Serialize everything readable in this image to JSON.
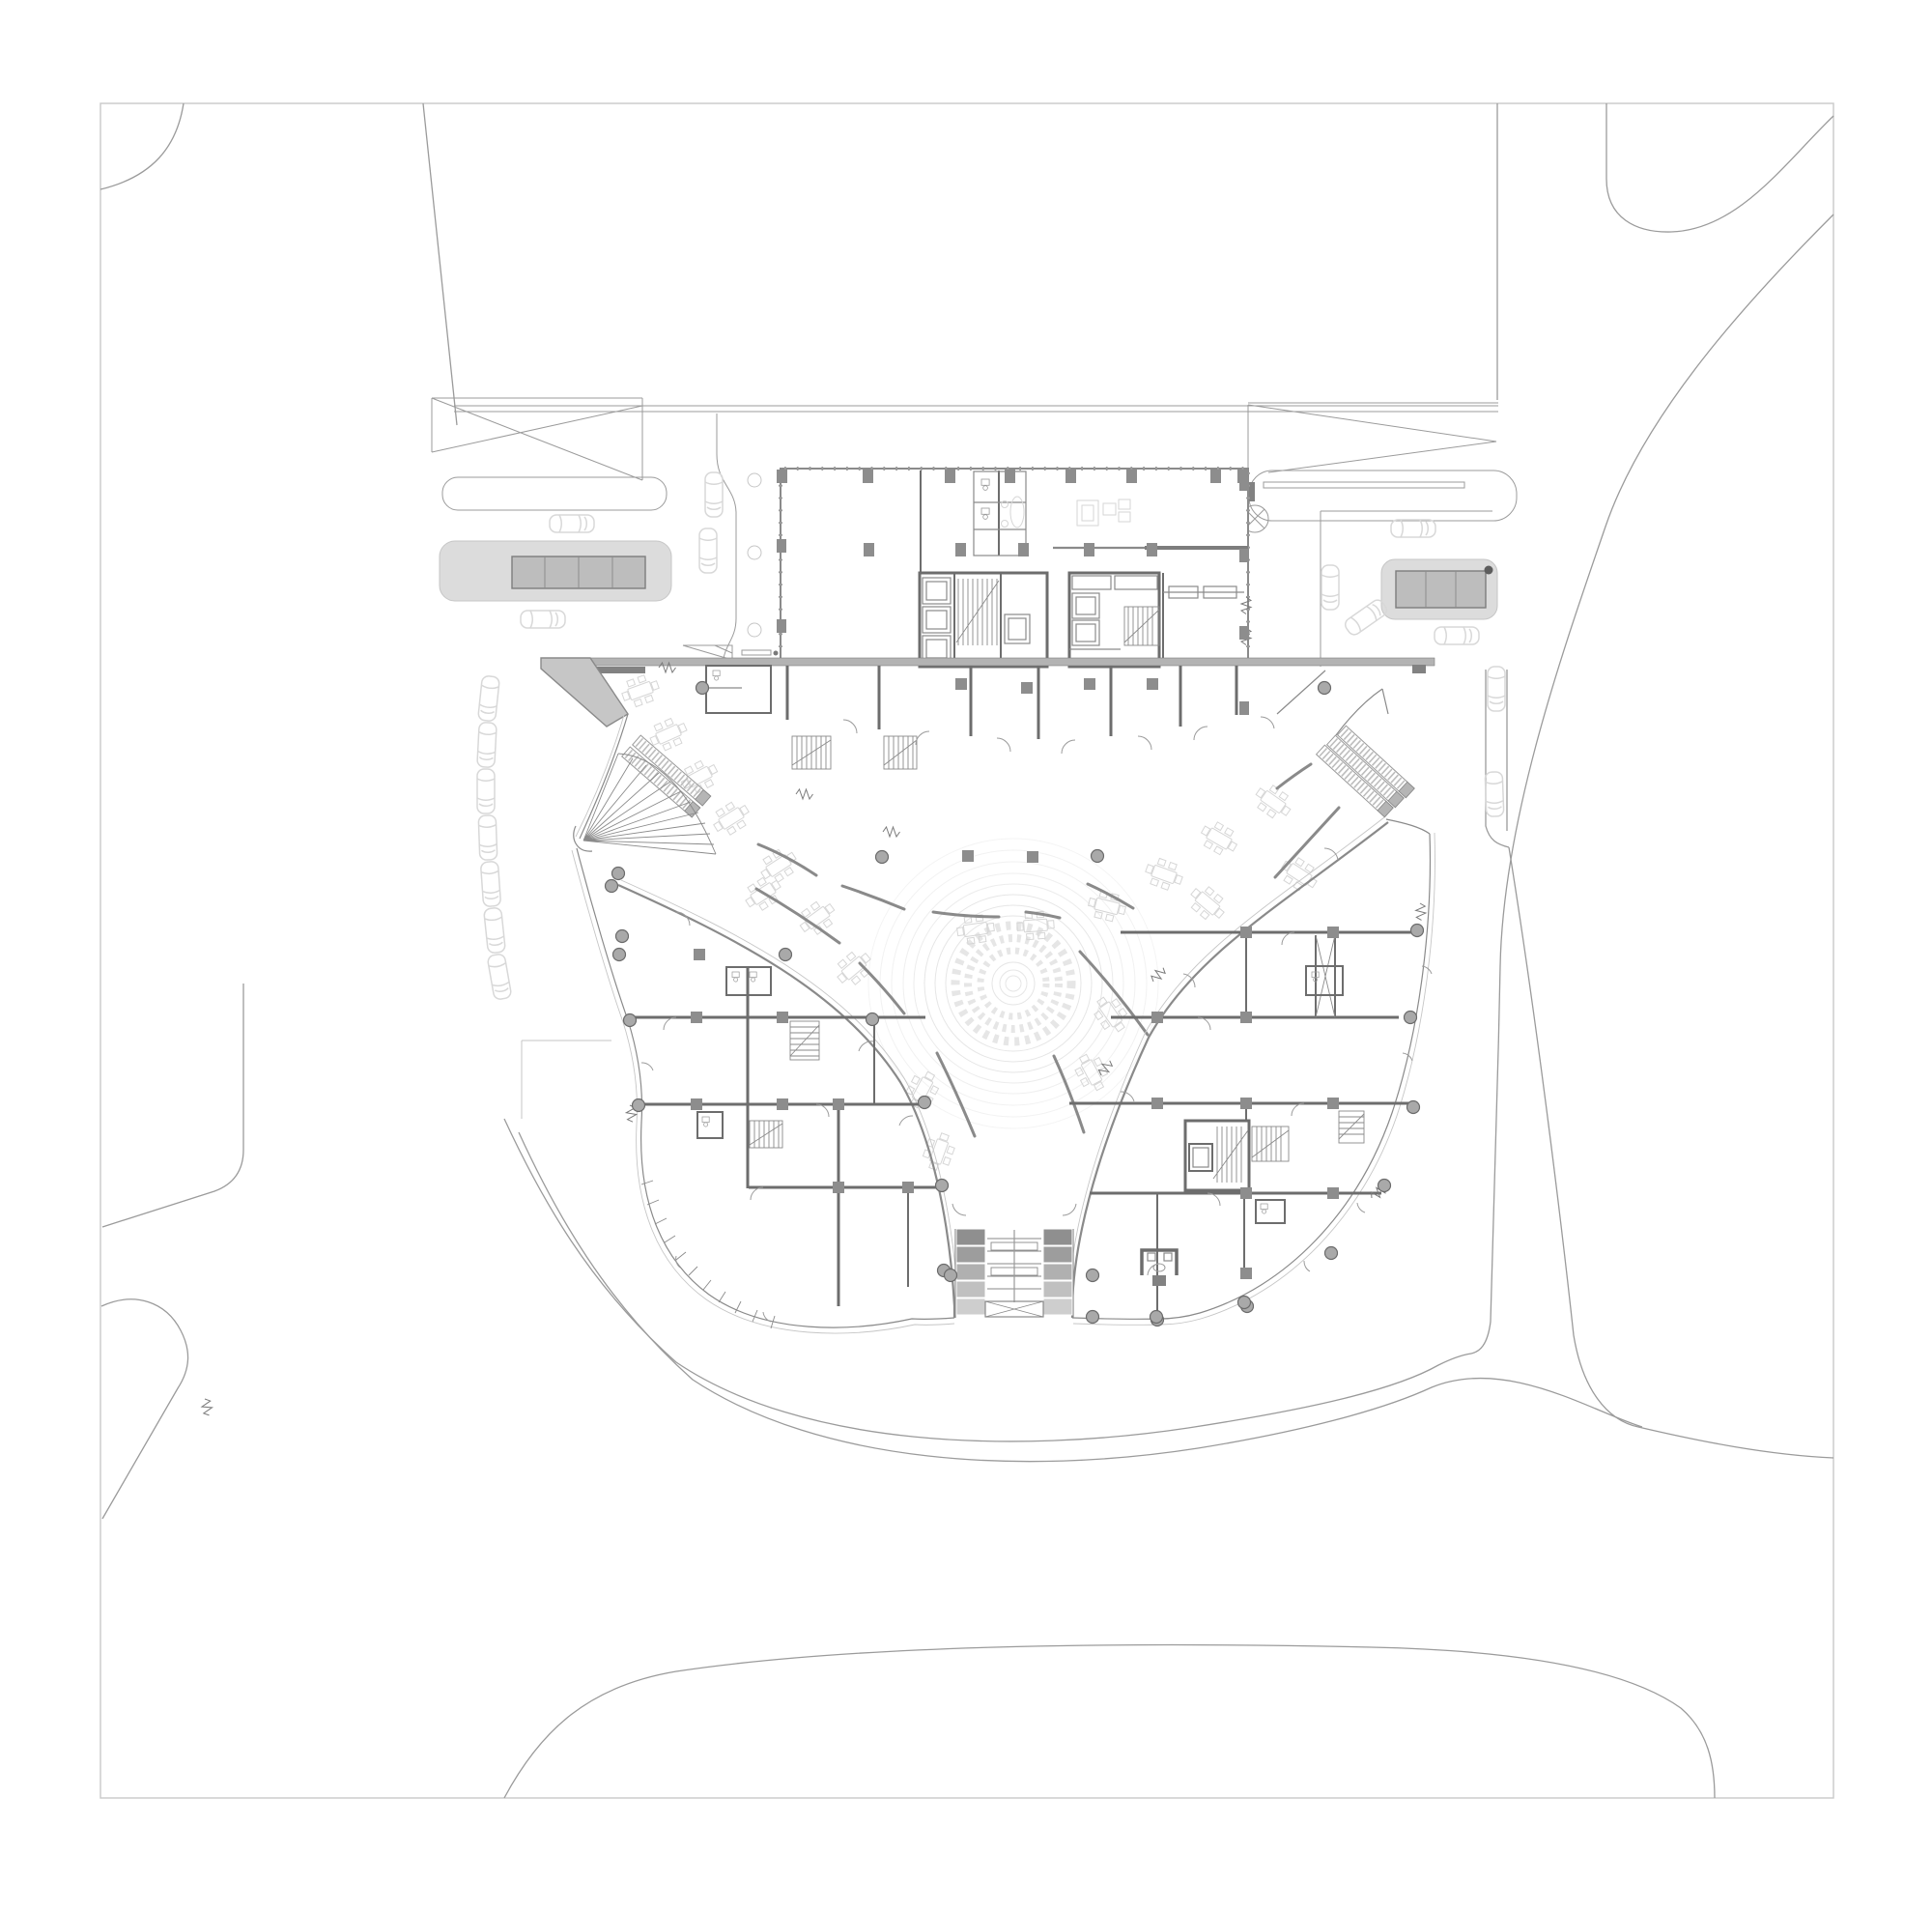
{
  "sheet": {
    "visible_text": [],
    "kind": "architectural ground-floor site plan, line drawing, no text labels",
    "symbols": [
      "car",
      "parking-pad",
      "drop-off-curb",
      "ramp-hatch",
      "tower-floor-plate",
      "elevator-core",
      "stair",
      "escalator-bank",
      "fan-stair",
      "canopy",
      "entrance-wedge",
      "shop-stub",
      "seating-cluster",
      "bench-wall",
      "round-column",
      "square-column",
      "door-swing",
      "expansion-joint",
      "spiral-court",
      "grand-stair",
      "revolving-entrance",
      "site-road",
      "sheet-frame"
    ]
  },
  "palette": {
    "bg": "#ffffff",
    "frame": "#c9c9c9",
    "site_line": "#9b9b9b",
    "faint_line": "#c6c6c6",
    "wall": "#6d6d6d",
    "wall_light": "#8a8a8a",
    "dark_fill": "#828282",
    "pad_fill": "#dcdcdc",
    "pad_bar_fill": "#bdbdbd",
    "canopy_fill": "#b3b3b3",
    "wedge_fill": "#c6c6c6",
    "car_line": "#d8d8d8",
    "seat_line": "#d6d6d6",
    "spiral_line": "#e6e6e6",
    "tread_dark": "#8f8f8f",
    "tread_mid": "#b0b0b0",
    "tread_light": "#cecece"
  }
}
